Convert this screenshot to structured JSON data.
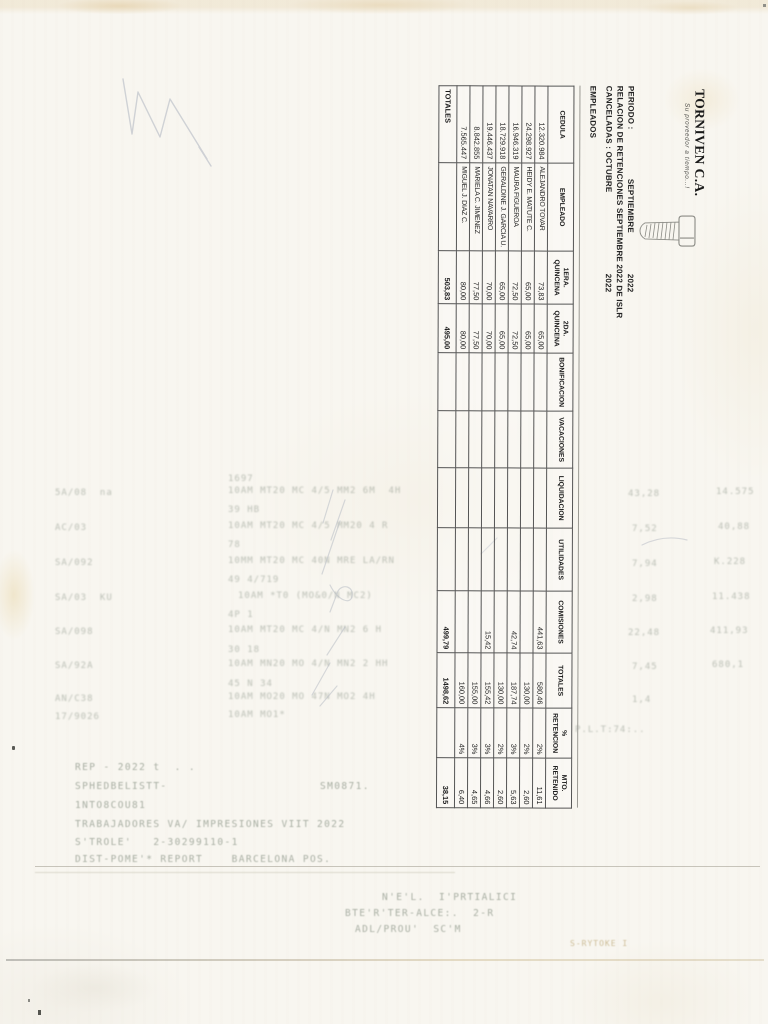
{
  "logo": {
    "name": "TORNIVEN C.A.",
    "tagline": "Su proveedor a tiempo...!"
  },
  "header": {
    "periodo_label": "PERIODO :",
    "periodo_value": "SEPTIEMBRE",
    "periodo_year": "2022",
    "relacion_line": "RELACION DE RETENCIONES SEPTIEMBRE 2022 DE ISLR",
    "canceladas_label": "CANCELADAS : OCTUBRE",
    "canceladas_year": "2022",
    "empleados_label": "EMPLEADOS"
  },
  "table": {
    "headers": [
      [
        "CEDULA"
      ],
      [
        "EMPLEADO"
      ],
      [
        "1ERA.",
        "QUINCENA"
      ],
      [
        "2DA.",
        "QUINCENA"
      ],
      [
        "BONIFICACION"
      ],
      [
        "VACACIONES"
      ],
      [
        "LIQUIDACION"
      ],
      [
        "UTILIDADES"
      ],
      [
        "COMISIONES"
      ],
      [
        "TOTALES"
      ],
      [
        "%",
        "RETENCION"
      ],
      [
        "MTO.",
        "RETENIDO"
      ]
    ],
    "col_widths": [
      77,
      88,
      53,
      49,
      58,
      57,
      60,
      63,
      62,
      55,
      50,
      50
    ],
    "rows": [
      [
        "12.320.984",
        "ALEJANDRO TOVAR",
        "73,83",
        "65,00",
        "",
        "",
        "",
        "",
        "441,63",
        "580,46",
        "2%",
        "11,61"
      ],
      [
        "24.298.927",
        "HEIDY E. MATUTE C.",
        "65,00",
        "65,00",
        "",
        "",
        "",
        "",
        "",
        "130,00",
        "2%",
        "2,60"
      ],
      [
        "16.946.319",
        "MAURA FIGUEROA",
        "72,50",
        "72,50",
        "",
        "",
        "",
        "",
        "42,74",
        "187,74",
        "3%",
        "5,63"
      ],
      [
        "18.729.918",
        "GERALDINE J. GARCIA U.",
        "65,00",
        "65,00",
        "",
        "",
        "",
        "",
        "",
        "130,00",
        "2%",
        "2,60"
      ],
      [
        "19.446.437",
        "JONATAN NAVARRO",
        "70,00",
        "70,00",
        "",
        "",
        "",
        "",
        "15,42",
        "155,42",
        "3%",
        "4,66"
      ],
      [
        "8.842.855",
        "MARIELA C. JIMENEZ",
        "77,50",
        "77,50",
        "",
        "",
        "",
        "",
        "",
        "155,00",
        "3%",
        "4,65"
      ],
      [
        "7.565.447",
        "MIGUEL J. DIAZ C.",
        "80,00",
        "80,00",
        "",
        "",
        "",
        "",
        "",
        "160,00",
        "4%",
        "6,40"
      ]
    ],
    "totals": [
      "TOTALES",
      "",
      "503,83",
      "495,00",
      "",
      "",
      "",
      "",
      "499,79",
      "1498,62",
      "",
      "38,15"
    ]
  },
  "ghost_fragments": [
    {
      "x": 228,
      "y": 474,
      "t": "1697",
      "c": "ga"
    },
    {
      "x": 55,
      "y": 488,
      "t": "5A/08  na",
      "c": "ga"
    },
    {
      "x": 228,
      "y": 486,
      "t": "10AM MT20 MC 4/5 MM2 6M  4H",
      "c": "ga"
    },
    {
      "x": 628,
      "y": 489,
      "t": "43,28",
      "c": "ga"
    },
    {
      "x": 716,
      "y": 487,
      "t": "14.575",
      "c": "ga"
    },
    {
      "x": 228,
      "y": 505,
      "t": "39 HB",
      "c": "ga"
    },
    {
      "x": 55,
      "y": 523,
      "t": "AC/03",
      "c": "ga"
    },
    {
      "x": 228,
      "y": 521,
      "t": "10AM MT20 MC 4/5 MM20 4 R",
      "c": "ga"
    },
    {
      "x": 632,
      "y": 524,
      "t": "7,52",
      "c": "ga"
    },
    {
      "x": 718,
      "y": 522,
      "t": "40,88",
      "c": "ga"
    },
    {
      "x": 228,
      "y": 540,
      "t": "78",
      "c": "ga"
    },
    {
      "x": 55,
      "y": 558,
      "t": "SA/092",
      "c": "ga"
    },
    {
      "x": 228,
      "y": 556,
      "t": "10MM MT20 MC 40N MRE LA/RN",
      "c": "ga"
    },
    {
      "x": 632,
      "y": 559,
      "t": "7,94",
      "c": "ga"
    },
    {
      "x": 714,
      "y": 557,
      "t": "K.228",
      "c": "ga"
    },
    {
      "x": 228,
      "y": 575,
      "t": "49 4/719",
      "c": "ga"
    },
    {
      "x": 55,
      "y": 593,
      "t": "SA/03  KU",
      "c": "ga"
    },
    {
      "x": 238,
      "y": 591,
      "t": "10AM *T0 (MO&0/N MC2)",
      "c": "ga"
    },
    {
      "x": 632,
      "y": 594,
      "t": "2,98",
      "c": "ga"
    },
    {
      "x": 712,
      "y": 592,
      "t": "11.438",
      "c": "ga"
    },
    {
      "x": 228,
      "y": 610,
      "t": "4P 1",
      "c": "ga"
    },
    {
      "x": 55,
      "y": 627,
      "t": "SA/098",
      "c": "ga"
    },
    {
      "x": 228,
      "y": 625,
      "t": "10AM MT20 MC 4/N MN2 6 H",
      "c": "ga"
    },
    {
      "x": 628,
      "y": 628,
      "t": "22,48",
      "c": "ga"
    },
    {
      "x": 710,
      "y": 626,
      "t": "411,93",
      "c": "ga"
    },
    {
      "x": 228,
      "y": 645,
      "t": "30 18",
      "c": "ga"
    },
    {
      "x": 55,
      "y": 661,
      "t": "SA/92A",
      "c": "ga"
    },
    {
      "x": 228,
      "y": 659,
      "t": "10AM MN20 MO 4/N MN2 2 HH",
      "c": "ga"
    },
    {
      "x": 632,
      "y": 662,
      "t": "7,45",
      "c": "ga"
    },
    {
      "x": 712,
      "y": 660,
      "t": "680,1",
      "c": "ga"
    },
    {
      "x": 228,
      "y": 679,
      "t": "45 N 34",
      "c": "ga"
    },
    {
      "x": 55,
      "y": 694,
      "t": "AN/C38",
      "c": "ga"
    },
    {
      "x": 228,
      "y": 692,
      "t": "10AM MO20 MO 47N MO2 4H",
      "c": "ga"
    },
    {
      "x": 632,
      "y": 695,
      "t": "1,4",
      "c": "ga"
    },
    {
      "x": 55,
      "y": 712,
      "t": "17/9026",
      "c": "ga"
    },
    {
      "x": 228,
      "y": 710,
      "t": "10AM MO1*",
      "c": "ga"
    },
    {
      "x": 575,
      "y": 725,
      "t": "P.L.T:74:..",
      "c": "ga"
    },
    {
      "x": 75,
      "y": 762,
      "t": "REP - 2022 t  . .",
      "c": "gb"
    },
    {
      "x": 75,
      "y": 781,
      "t": "SPHEDBELISTT-",
      "c": "gb"
    },
    {
      "x": 320,
      "y": 781,
      "t": "SM0871.",
      "c": "gb"
    },
    {
      "x": 75,
      "y": 800,
      "t": "1NTO8COU81",
      "c": "gb"
    },
    {
      "x": 75,
      "y": 819,
      "t": "TRABAJADORES VA/ IMPRESIONES VIIT 2022",
      "c": "gb"
    },
    {
      "x": 75,
      "y": 837,
      "t": "S'TROLE'   2-30299110-1",
      "c": "gb"
    },
    {
      "x": 75,
      "y": 854,
      "t": "DIST-POME'* REPORT    BARCELONA POS.",
      "c": "gb"
    },
    {
      "x": 382,
      "y": 892,
      "t": "N'E'L.  I'PRTIALICI",
      "c": "gb"
    },
    {
      "x": 345,
      "y": 908,
      "t": "BTE'R'TER-ALCE:.  2-R",
      "c": "gb"
    },
    {
      "x": 355,
      "y": 924,
      "t": "ADL/PROU'  SC'M",
      "c": "gb"
    },
    {
      "x": 570,
      "y": 939,
      "t": "S-RYTOKE I",
      "c": "gt"
    }
  ]
}
